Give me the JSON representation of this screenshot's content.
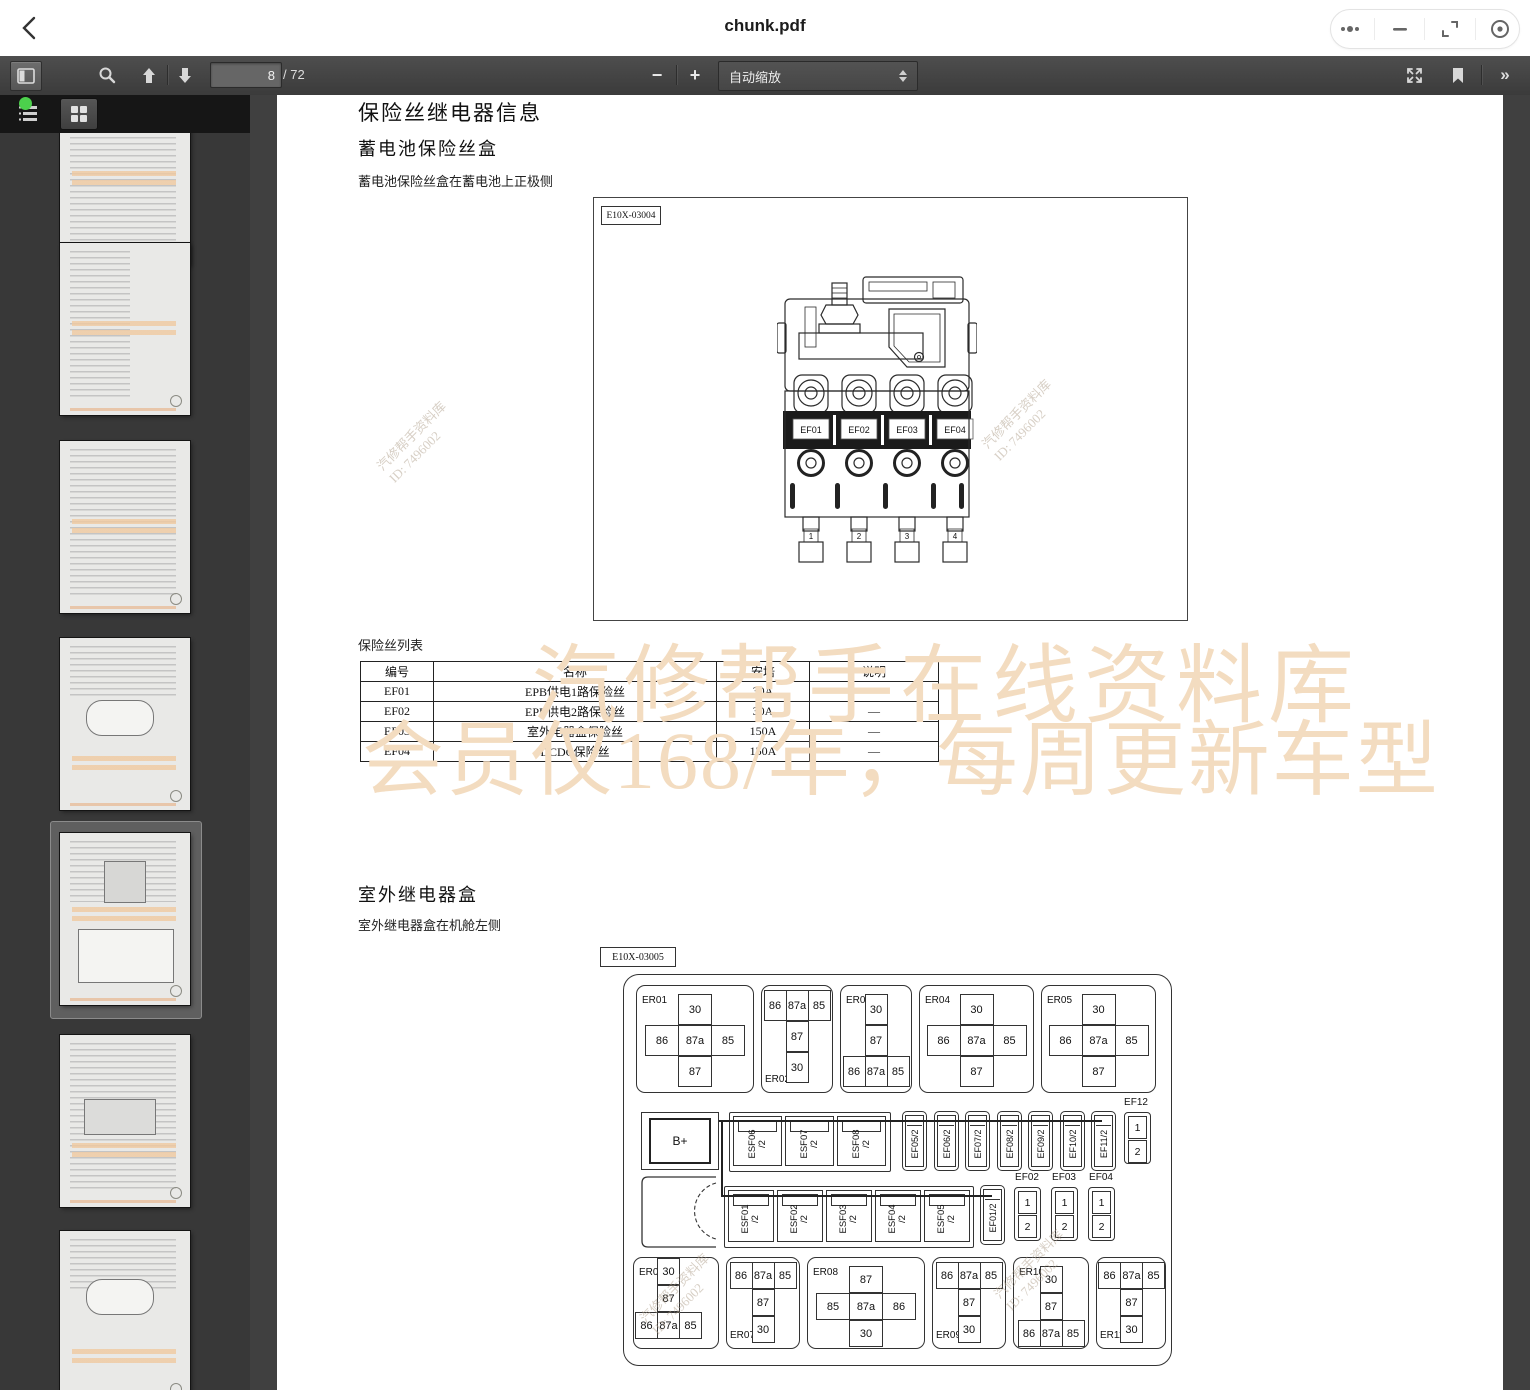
{
  "app": {
    "title": "chunk.pdf"
  },
  "toolbar": {
    "page_input": "8",
    "page_total": "/ 72",
    "zoom_out": "−",
    "zoom_in": "+",
    "zoom_select": "自动缩放",
    "more_chevron": "»"
  },
  "page": {
    "h1": "保险丝继电器信息",
    "h2_battery": "蓄电池保险丝盒",
    "cap_battery": "蓄电池保险丝盒在蓄电池上正极侧",
    "fig1_label": "E10X-03004",
    "fuse_list_title": "保险丝列表",
    "h2_relay": "室外继电器盒",
    "cap_relay": "室外继电器盒在机舱左侧",
    "fig2_label": "E10X-03005"
  },
  "fuse_table": {
    "headers": [
      "编号",
      "名称",
      "安培",
      "说明"
    ],
    "col_widths": [
      64,
      274,
      84,
      120
    ],
    "rows": [
      [
        "EF01",
        "EPB供电1路保险丝",
        "30A",
        "—"
      ],
      [
        "EF02",
        "EPB供电2路保险丝",
        "30A",
        "—"
      ],
      [
        "EF03",
        "室外电器盒保险丝",
        "150A",
        "—"
      ],
      [
        "EF04",
        "DCDC保险丝",
        "150A",
        "—"
      ]
    ]
  },
  "watermark": {
    "line1": "汽修帮手在线资料库",
    "line2": "会员仅168/年，每周更新车型",
    "diag_line1": "汽修帮手资料库",
    "diag_line2": "ID: 7496002",
    "color": "#f3dcc0"
  },
  "figure1": {
    "fuses": [
      "EF01",
      "EF02",
      "EF03",
      "EF04"
    ],
    "terminals": [
      "1",
      "2",
      "3",
      "4"
    ]
  },
  "figure2": {
    "bplus": "B+",
    "relays_top": [
      {
        "id": "ER01",
        "label_pos": "tl",
        "w": 118,
        "rows": [
          [
            "30"
          ],
          [
            "86",
            "87a",
            "85"
          ],
          [
            "87"
          ]
        ]
      },
      {
        "id": "ER02",
        "label_pos": "bl",
        "w": 72,
        "rows": [
          [
            "86",
            "87a",
            "85"
          ],
          [
            "87"
          ],
          [
            "30"
          ]
        ]
      },
      {
        "id": "ER03",
        "label_pos": "tl",
        "w": 72,
        "rows": [
          [
            "30"
          ],
          [
            "87"
          ],
          [
            "86",
            "87a",
            "85"
          ]
        ]
      },
      {
        "id": "ER04",
        "label_pos": "tl",
        "w": 115,
        "rows": [
          [
            "30"
          ],
          [
            "86",
            "87a",
            "85"
          ],
          [
            "87"
          ]
        ]
      },
      {
        "id": "ER05",
        "label_pos": "tl",
        "w": 115,
        "rows": [
          [
            "30"
          ],
          [
            "86",
            "87a",
            "85"
          ],
          [
            "87"
          ]
        ]
      }
    ],
    "relays_bottom": [
      {
        "id": "ER06",
        "label_pos": "tl",
        "w": 86,
        "align": "left",
        "rows": [
          [
            "30"
          ],
          [
            "87"
          ],
          [
            "86",
            "87a",
            "85"
          ]
        ]
      },
      {
        "id": "ER07",
        "label_pos": "bl",
        "w": 74,
        "rows": [
          [
            "86",
            "87a",
            "85"
          ],
          [
            "87"
          ],
          [
            "30"
          ]
        ]
      },
      {
        "id": "ER08",
        "label_pos": "tl",
        "w": 118,
        "rows": [
          [
            "87"
          ],
          [
            "85",
            "87a",
            "86"
          ],
          [
            "30"
          ]
        ]
      },
      {
        "id": "ER09",
        "label_pos": "bl",
        "w": 74,
        "rows": [
          [
            "86",
            "87a",
            "85"
          ],
          [
            "87"
          ],
          [
            "30"
          ]
        ]
      },
      {
        "id": "ER10",
        "label_pos": "tl",
        "w": 76,
        "rows": [
          [
            "30"
          ],
          [
            "87"
          ],
          [
            "86",
            "87a",
            "85"
          ]
        ]
      },
      {
        "id": "ER11",
        "label_pos": "bl",
        "w": 70,
        "rows": [
          [
            "86",
            "87a",
            "85"
          ],
          [
            "87"
          ],
          [
            "30"
          ]
        ]
      }
    ],
    "esf_row_a": [
      "ESF06",
      "ESF07",
      "ESF08"
    ],
    "esf_row_b": [
      "ESF01",
      "ESF02",
      "ESF03",
      "ESF04",
      "ESF05"
    ],
    "esf_suffix": "/2",
    "ef_vertical_a": [
      "EF05/2",
      "EF06/2",
      "EF07/2",
      "EF08/2",
      "EF09/2",
      "EF10/2",
      "EF11/2"
    ],
    "ef01_vertical": "EF01/2",
    "ef12": {
      "label": "EF12",
      "cells": [
        "1",
        "2"
      ]
    },
    "ef_pairs": [
      {
        "label": "EF02",
        "cells": [
          "1",
          "2"
        ]
      },
      {
        "label": "EF03",
        "cells": [
          "1",
          "2"
        ]
      },
      {
        "label": "EF04",
        "cells": [
          "1",
          "2"
        ]
      }
    ]
  },
  "sidebar": {
    "thumbs": [
      {
        "kind": "partial",
        "selected": false
      },
      {
        "kind": "toc",
        "selected": false
      },
      {
        "kind": "text",
        "selected": false
      },
      {
        "kind": "cars",
        "selected": false
      },
      {
        "kind": "page8",
        "selected": true
      },
      {
        "kind": "tables",
        "selected": false
      },
      {
        "kind": "car2",
        "selected": false
      }
    ]
  }
}
